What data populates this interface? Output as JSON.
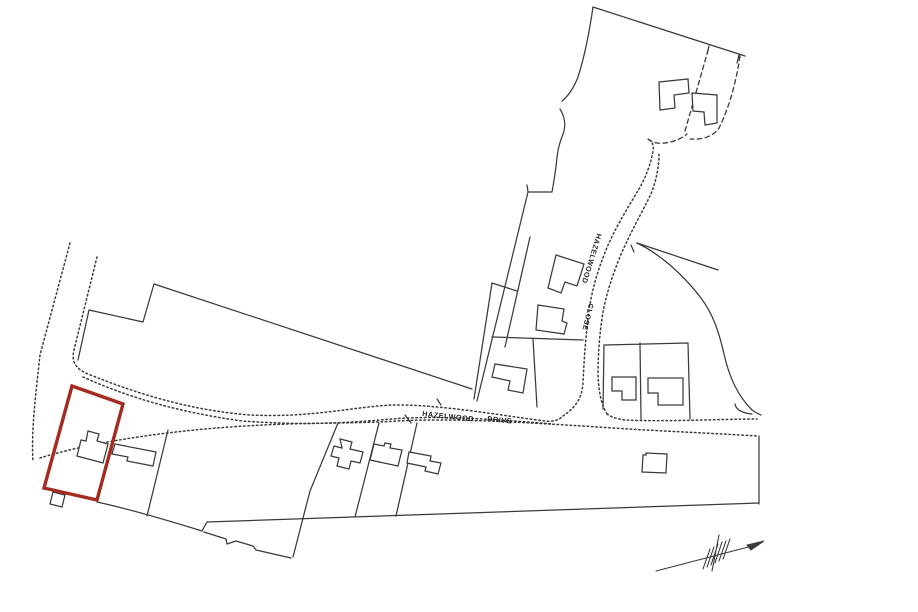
{
  "plan": {
    "background": "#ffffff",
    "ink": "#3a3a3a",
    "label_ink": "#1f1f1f",
    "highlight": "#a32b1f",
    "labels": {
      "drive_word1": "HAZELWOOD",
      "drive_word2": "DRIVE",
      "close_word1": "HAZELWOOD",
      "close_word2": "CLOSE"
    },
    "icons": {
      "north_arrow": "north-arrow"
    }
  }
}
